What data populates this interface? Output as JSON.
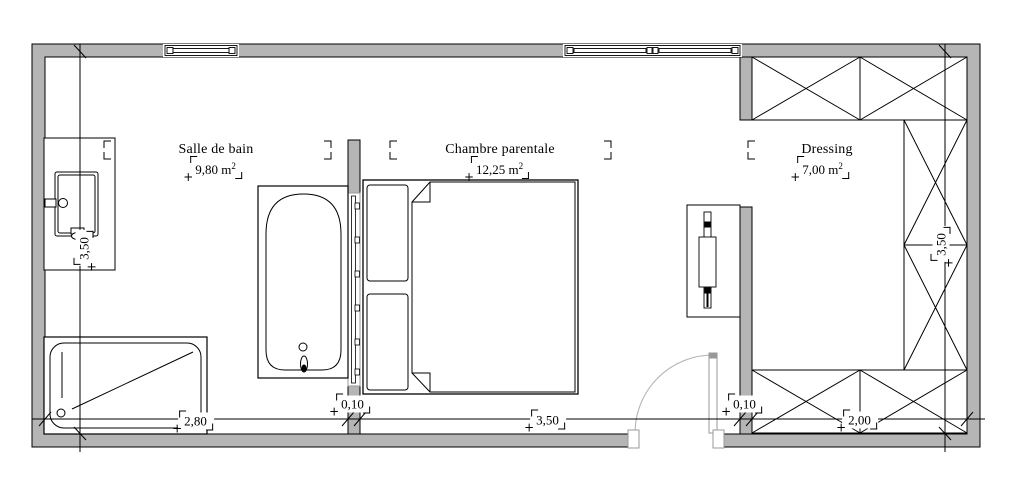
{
  "marks": {
    "plus": "+"
  },
  "rooms": [
    {
      "name": "Salle de bain",
      "area_value": "9,80 m",
      "area_exp": "2"
    },
    {
      "name": "Chambre parentale",
      "area_value": "12,25 m",
      "area_exp": "2"
    },
    {
      "name": "Dressing",
      "area_value": "7,00 m",
      "area_exp": "2"
    }
  ],
  "dims": {
    "bottom": [
      "2,80",
      "0,10",
      "3,50",
      "0,10",
      "2,00"
    ],
    "left": "3,50",
    "right": "3,50"
  }
}
